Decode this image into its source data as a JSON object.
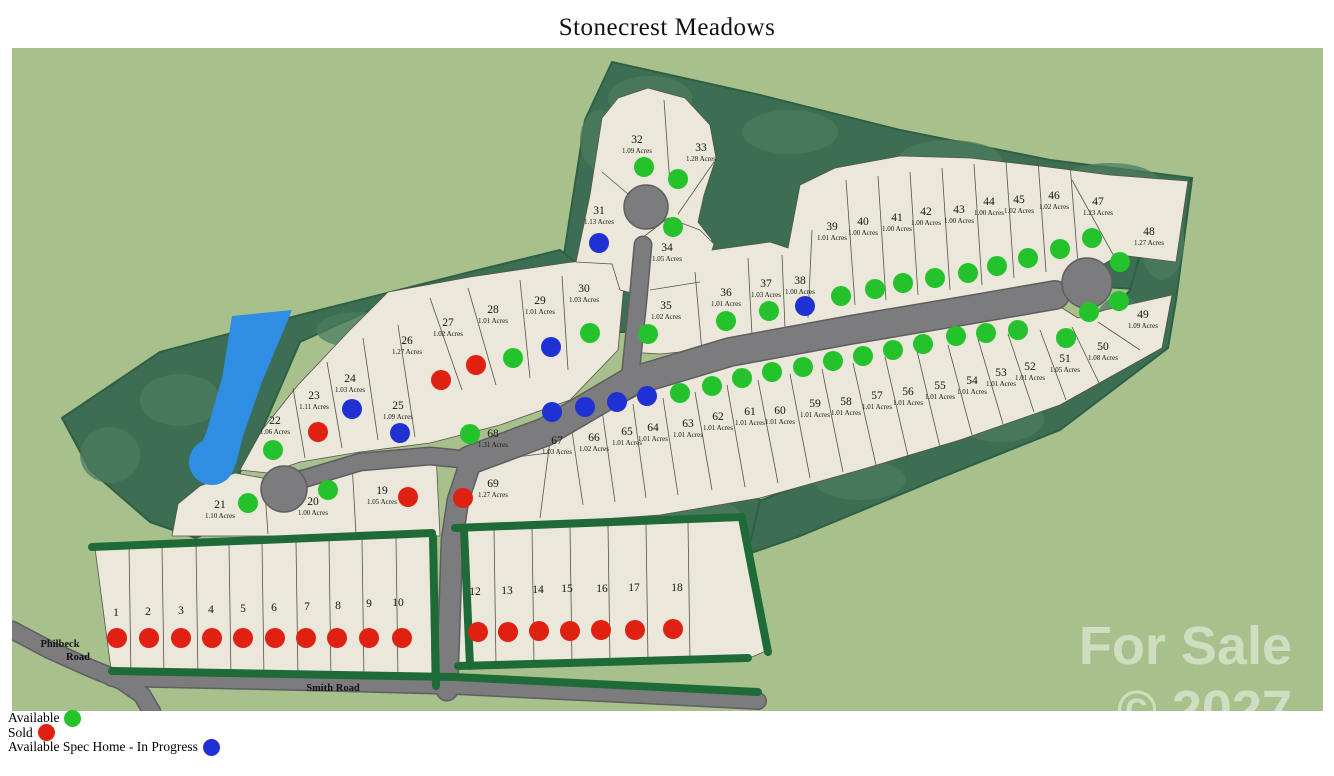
{
  "title": "Stonecrest Meadows",
  "legend": {
    "items": [
      {
        "label": "Available",
        "status": "available",
        "color": "#25c32b"
      },
      {
        "label": "Sold",
        "status": "sold",
        "color": "#e02112"
      },
      {
        "label": "Available Spec Home - In Progress",
        "status": "spec",
        "color": "#2031d4"
      }
    ]
  },
  "roads": {
    "philbeck_line1": "Philbeck",
    "philbeck_line2": "Road",
    "smith": "Smith Road"
  },
  "watermark": {
    "line1": "For Sale",
    "line2": "© 2027"
  },
  "map_colors": {
    "ground": "#a8c18c",
    "forest": "#3b6e52",
    "hedge": "#1f6b37",
    "lot_fill": "#ebe7da",
    "road": "#7c7c7e",
    "pond": "#2f8ee3"
  },
  "lots": [
    {
      "n": "1",
      "acres": "",
      "status": "sold",
      "lx": 116,
      "ly": 616,
      "dx": 117,
      "dy": 638
    },
    {
      "n": "2",
      "acres": "",
      "status": "sold",
      "lx": 148,
      "ly": 615,
      "dx": 149,
      "dy": 638
    },
    {
      "n": "3",
      "acres": "",
      "status": "sold",
      "lx": 181,
      "ly": 614,
      "dx": 181,
      "dy": 638
    },
    {
      "n": "4",
      "acres": "",
      "status": "sold",
      "lx": 211,
      "ly": 613,
      "dx": 212,
      "dy": 638
    },
    {
      "n": "5",
      "acres": "",
      "status": "sold",
      "lx": 243,
      "ly": 612,
      "dx": 243,
      "dy": 638
    },
    {
      "n": "6",
      "acres": "",
      "status": "sold",
      "lx": 274,
      "ly": 611,
      "dx": 275,
      "dy": 638
    },
    {
      "n": "7",
      "acres": "",
      "status": "sold",
      "lx": 307,
      "ly": 610,
      "dx": 306,
      "dy": 638
    },
    {
      "n": "8",
      "acres": "",
      "status": "sold",
      "lx": 338,
      "ly": 609,
      "dx": 337,
      "dy": 638
    },
    {
      "n": "9",
      "acres": "",
      "status": "sold",
      "lx": 369,
      "ly": 607,
      "dx": 369,
      "dy": 638
    },
    {
      "n": "10",
      "acres": "",
      "status": "sold",
      "lx": 398,
      "ly": 606,
      "dx": 402,
      "dy": 638
    },
    {
      "n": "12",
      "acres": "",
      "status": "sold",
      "lx": 475,
      "ly": 595,
      "dx": 478,
      "dy": 632
    },
    {
      "n": "13",
      "acres": "",
      "status": "sold",
      "lx": 507,
      "ly": 594,
      "dx": 508,
      "dy": 632
    },
    {
      "n": "14",
      "acres": "",
      "status": "sold",
      "lx": 538,
      "ly": 593,
      "dx": 539,
      "dy": 631
    },
    {
      "n": "15",
      "acres": "",
      "status": "sold",
      "lx": 567,
      "ly": 592,
      "dx": 570,
      "dy": 631
    },
    {
      "n": "16",
      "acres": "",
      "status": "sold",
      "lx": 602,
      "ly": 592,
      "dx": 601,
      "dy": 630
    },
    {
      "n": "17",
      "acres": "",
      "status": "sold",
      "lx": 634,
      "ly": 591,
      "dx": 635,
      "dy": 630
    },
    {
      "n": "18",
      "acres": "",
      "status": "sold",
      "lx": 677,
      "ly": 591,
      "dx": 673,
      "dy": 629
    },
    {
      "n": "19",
      "acres": "1.05 Acres",
      "status": "sold",
      "lx": 382,
      "ly": 494,
      "dx": 408,
      "dy": 497
    },
    {
      "n": "20",
      "acres": "1.00 Acres",
      "status": "available",
      "lx": 313,
      "ly": 505,
      "dx": 328,
      "dy": 490
    },
    {
      "n": "21",
      "acres": "1.10 Acres",
      "status": "available",
      "lx": 220,
      "ly": 508,
      "dx": 248,
      "dy": 503
    },
    {
      "n": "22",
      "acres": "1.06 Acres",
      "status": "available",
      "lx": 275,
      "ly": 424,
      "dx": 273,
      "dy": 450
    },
    {
      "n": "23",
      "acres": "1.11 Acres",
      "status": "sold",
      "lx": 314,
      "ly": 399,
      "dx": 318,
      "dy": 432
    },
    {
      "n": "24",
      "acres": "1.03 Acres",
      "status": "spec",
      "lx": 350,
      "ly": 382,
      "dx": 352,
      "dy": 409
    },
    {
      "n": "25",
      "acres": "1.09 Acres",
      "status": "spec",
      "lx": 398,
      "ly": 409,
      "dx": 400,
      "dy": 433
    },
    {
      "n": "26",
      "acres": "1.27 Acres",
      "status": "sold",
      "lx": 407,
      "ly": 344,
      "dx": 441,
      "dy": 380
    },
    {
      "n": "27",
      "acres": "1.02 Acres",
      "status": "sold",
      "lx": 448,
      "ly": 326,
      "dx": 476,
      "dy": 365
    },
    {
      "n": "28",
      "acres": "1.01 Acres",
      "status": "available",
      "lx": 493,
      "ly": 313,
      "dx": 513,
      "dy": 358
    },
    {
      "n": "29",
      "acres": "1.01 Acres",
      "status": "spec",
      "lx": 540,
      "ly": 304,
      "dx": 551,
      "dy": 347
    },
    {
      "n": "30",
      "acres": "1.03 Acres",
      "status": "available",
      "lx": 584,
      "ly": 292,
      "dx": 590,
      "dy": 333
    },
    {
      "n": "31",
      "acres": "1.13 Acres",
      "status": "spec",
      "lx": 599,
      "ly": 214,
      "dx": 599,
      "dy": 243
    },
    {
      "n": "32",
      "acres": "1.09 Acres",
      "status": "available",
      "lx": 637,
      "ly": 143,
      "dx": 644,
      "dy": 167
    },
    {
      "n": "33",
      "acres": "1.28 Acres",
      "status": "available",
      "lx": 701,
      "ly": 151,
      "dx": 678,
      "dy": 179
    },
    {
      "n": "34",
      "acres": "1.05 Acres",
      "status": "available",
      "lx": 667,
      "ly": 251,
      "dx": 673,
      "dy": 227
    },
    {
      "n": "35",
      "acres": "1.02 Acres",
      "status": "available",
      "lx": 666,
      "ly": 309,
      "dx": 648,
      "dy": 334
    },
    {
      "n": "36",
      "acres": "1.01 Acres",
      "status": "available",
      "lx": 726,
      "ly": 296,
      "dx": 726,
      "dy": 321
    },
    {
      "n": "37",
      "acres": "1.03 Acres",
      "status": "available",
      "lx": 766,
      "ly": 287,
      "dx": 769,
      "dy": 311
    },
    {
      "n": "38",
      "acres": "1.00 Acres",
      "status": "spec",
      "lx": 800,
      "ly": 284,
      "dx": 805,
      "dy": 306
    },
    {
      "n": "39",
      "acres": "1.01 Acres",
      "status": "available",
      "lx": 832,
      "ly": 230,
      "dx": 841,
      "dy": 296
    },
    {
      "n": "40",
      "acres": "1.00 Acres",
      "status": "available",
      "lx": 863,
      "ly": 225,
      "dx": 875,
      "dy": 289
    },
    {
      "n": "41",
      "acres": "1.00 Acres",
      "status": "available",
      "lx": 897,
      "ly": 221,
      "dx": 903,
      "dy": 283
    },
    {
      "n": "42",
      "acres": "1.00 Acres",
      "status": "available",
      "lx": 926,
      "ly": 215,
      "dx": 935,
      "dy": 278
    },
    {
      "n": "43",
      "acres": "1.00 Acres",
      "status": "available",
      "lx": 959,
      "ly": 213,
      "dx": 968,
      "dy": 273
    },
    {
      "n": "44",
      "acres": "1.00 Acres",
      "status": "available",
      "lx": 989,
      "ly": 205,
      "dx": 997,
      "dy": 266
    },
    {
      "n": "45",
      "acres": "1.02 Acres",
      "status": "available",
      "lx": 1019,
      "ly": 203,
      "dx": 1028,
      "dy": 258
    },
    {
      "n": "46",
      "acres": "1.02 Acres",
      "status": "available",
      "lx": 1054,
      "ly": 199,
      "dx": 1060,
      "dy": 249
    },
    {
      "n": "47",
      "acres": "1.23 Acres",
      "status": "available",
      "lx": 1098,
      "ly": 205,
      "dx": 1092,
      "dy": 238
    },
    {
      "n": "48",
      "acres": "1.27 Acres",
      "status": "available",
      "lx": 1149,
      "ly": 235,
      "dx": 1120,
      "dy": 262
    },
    {
      "n": "49",
      "acres": "1.09 Acres",
      "status": "available",
      "lx": 1143,
      "ly": 318,
      "dx": 1119,
      "dy": 301
    },
    {
      "n": "50",
      "acres": "1.08 Acres",
      "status": "available",
      "lx": 1103,
      "ly": 350,
      "dx": 1089,
      "dy": 312
    },
    {
      "n": "51",
      "acres": "1.05 Acres",
      "status": "available",
      "lx": 1065,
      "ly": 362,
      "dx": 1066,
      "dy": 338
    },
    {
      "n": "52",
      "acres": "1.01 Acres",
      "status": "available",
      "lx": 1030,
      "ly": 370,
      "dx": 1018,
      "dy": 330
    },
    {
      "n": "53",
      "acres": "1.01 Acres",
      "status": "available",
      "lx": 1001,
      "ly": 376,
      "dx": 986,
      "dy": 333
    },
    {
      "n": "54",
      "acres": "1.01 Acres",
      "status": "available",
      "lx": 972,
      "ly": 384,
      "dx": 956,
      "dy": 336
    },
    {
      "n": "55",
      "acres": "1.01 Acres",
      "status": "available",
      "lx": 940,
      "ly": 389,
      "dx": 923,
      "dy": 344
    },
    {
      "n": "56",
      "acres": "1.01 Acres",
      "status": "available",
      "lx": 908,
      "ly": 395,
      "dx": 893,
      "dy": 350
    },
    {
      "n": "57",
      "acres": "1.01 Acres",
      "status": "available",
      "lx": 877,
      "ly": 399,
      "dx": 863,
      "dy": 356
    },
    {
      "n": "58",
      "acres": "1.01 Acres",
      "status": "available",
      "lx": 846,
      "ly": 405,
      "dx": 833,
      "dy": 361
    },
    {
      "n": "59",
      "acres": "1.01 Acres",
      "status": "available",
      "lx": 815,
      "ly": 407,
      "dx": 803,
      "dy": 367
    },
    {
      "n": "60",
      "acres": "1.01 Acres",
      "status": "available",
      "lx": 780,
      "ly": 414,
      "dx": 772,
      "dy": 372
    },
    {
      "n": "61",
      "acres": "1.01 Acres",
      "status": "available",
      "lx": 750,
      "ly": 415,
      "dx": 742,
      "dy": 378
    },
    {
      "n": "62",
      "acres": "1.01 Acres",
      "status": "available",
      "lx": 718,
      "ly": 420,
      "dx": 712,
      "dy": 386
    },
    {
      "n": "63",
      "acres": "1.01 Acres",
      "status": "available",
      "lx": 688,
      "ly": 427,
      "dx": 680,
      "dy": 393
    },
    {
      "n": "64",
      "acres": "1.01 Acres",
      "status": "spec",
      "lx": 653,
      "ly": 431,
      "dx": 647,
      "dy": 396
    },
    {
      "n": "65",
      "acres": "1.01 Acres",
      "status": "spec",
      "lx": 627,
      "ly": 435,
      "dx": 617,
      "dy": 402
    },
    {
      "n": "66",
      "acres": "1.02 Acres",
      "status": "spec",
      "lx": 594,
      "ly": 441,
      "dx": 585,
      "dy": 407
    },
    {
      "n": "67",
      "acres": "1.03 Acres",
      "status": "spec",
      "lx": 557,
      "ly": 444,
      "dx": 552,
      "dy": 412
    },
    {
      "n": "68",
      "acres": "1.31 Acres",
      "status": "available",
      "lx": 493,
      "ly": 437,
      "dx": 470,
      "dy": 434
    },
    {
      "n": "69",
      "acres": "1.27 Acres",
      "status": "sold",
      "lx": 493,
      "ly": 487,
      "dx": 463,
      "dy": 498
    }
  ]
}
